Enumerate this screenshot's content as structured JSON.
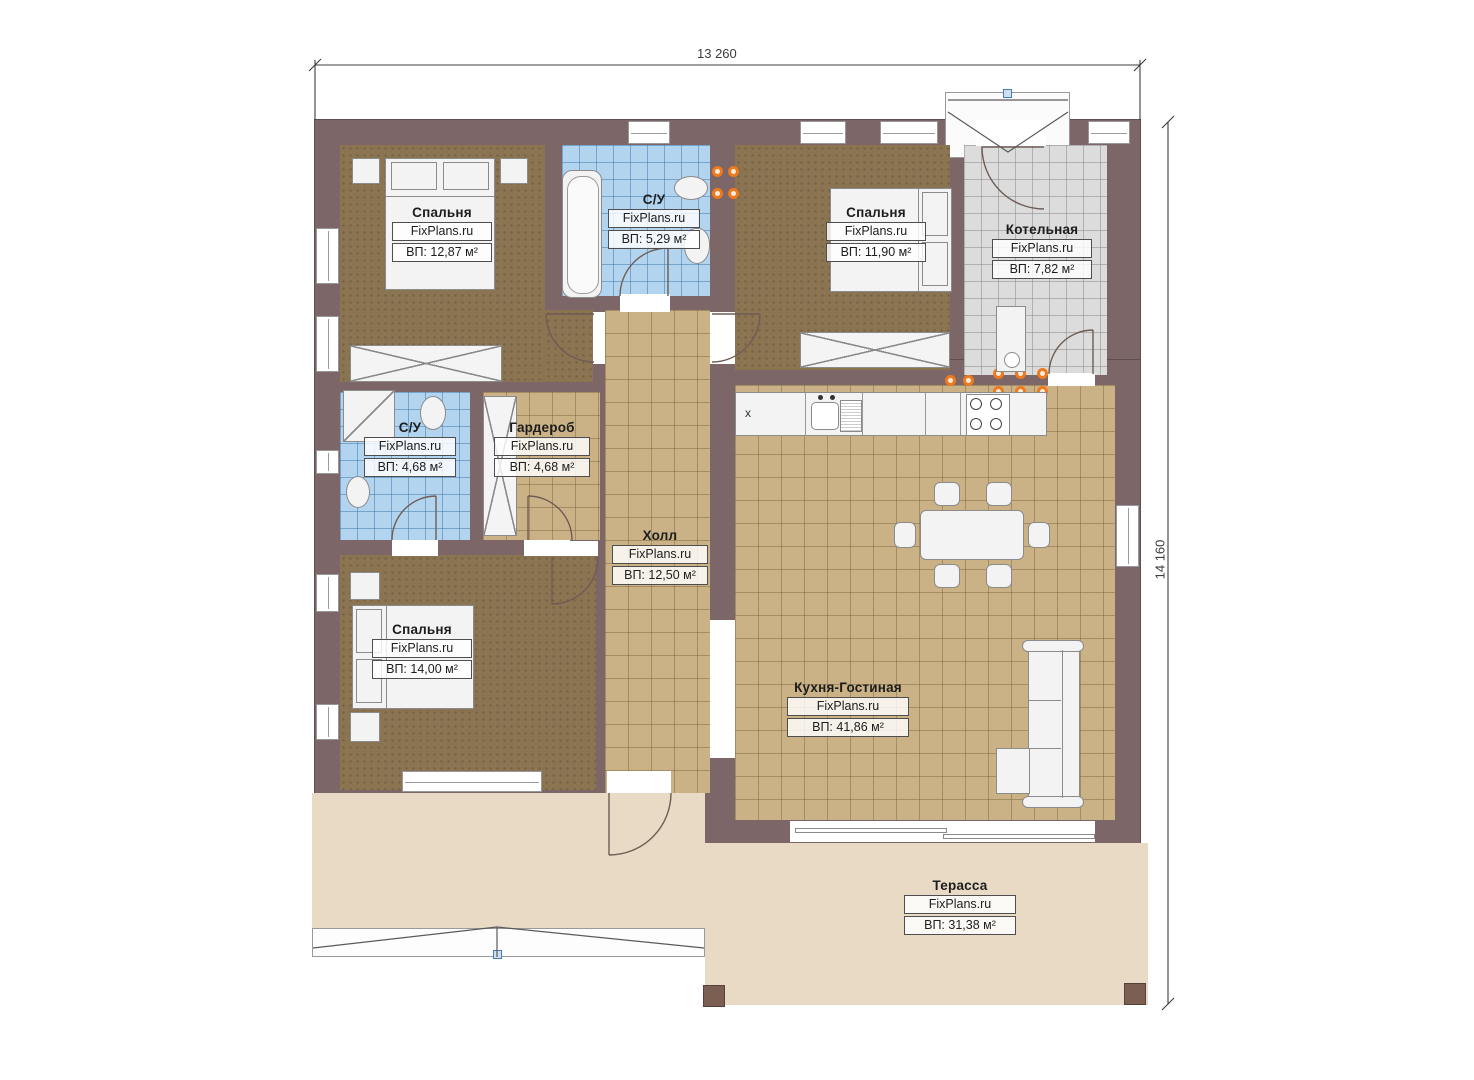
{
  "plan_title": "floor-plan",
  "dimensions": {
    "top": "13 260",
    "right": "14 160"
  },
  "rooms": [
    {
      "id": "bedroom-top-left",
      "name": "Спальня",
      "brand": "FixPlans.ru",
      "area": "ВП: 12,87 м²"
    },
    {
      "id": "bathroom-top",
      "name": "С/У",
      "brand": "FixPlans.ru",
      "area": "ВП: 5,29 м²"
    },
    {
      "id": "bedroom-top-right",
      "name": "Спальня",
      "brand": "FixPlans.ru",
      "area": "ВП: 11,90 м²"
    },
    {
      "id": "boiler-room",
      "name": "Котельная",
      "brand": "FixPlans.ru",
      "area": "ВП: 7,82 м²"
    },
    {
      "id": "bathroom-left",
      "name": "С/У",
      "brand": "FixPlans.ru",
      "area": "ВП: 4,68 м²"
    },
    {
      "id": "wardrobe",
      "name": "Гардероб",
      "brand": "FixPlans.ru",
      "area": "ВП: 4,68 м²"
    },
    {
      "id": "hall",
      "name": "Холл",
      "brand": "FixPlans.ru",
      "area": "ВП: 12,50 м²"
    },
    {
      "id": "bedroom-bottom",
      "name": "Спальня",
      "brand": "FixPlans.ru",
      "area": "ВП: 14,00 м²"
    },
    {
      "id": "kitchen-living",
      "name": "Кухня-Гостиная",
      "brand": "FixPlans.ru",
      "area": "ВП: 41,86 м²"
    },
    {
      "id": "terrace",
      "name": "Терасса",
      "brand": "FixPlans.ru",
      "area": "ВП: 31,38 м²"
    }
  ],
  "kitchen": {
    "counter_symbol": "х"
  },
  "colors": {
    "wall": "#7c6668",
    "bedroom_floor": "#8b7452",
    "tile_tan": "#cbb286",
    "tile_blue": "#b2d4ef",
    "tile_gray": "#dcdcdc",
    "terrace": "#e8dac5",
    "downlight_orange": "#ef7a1e",
    "marker_blue": "#4a78b8"
  }
}
